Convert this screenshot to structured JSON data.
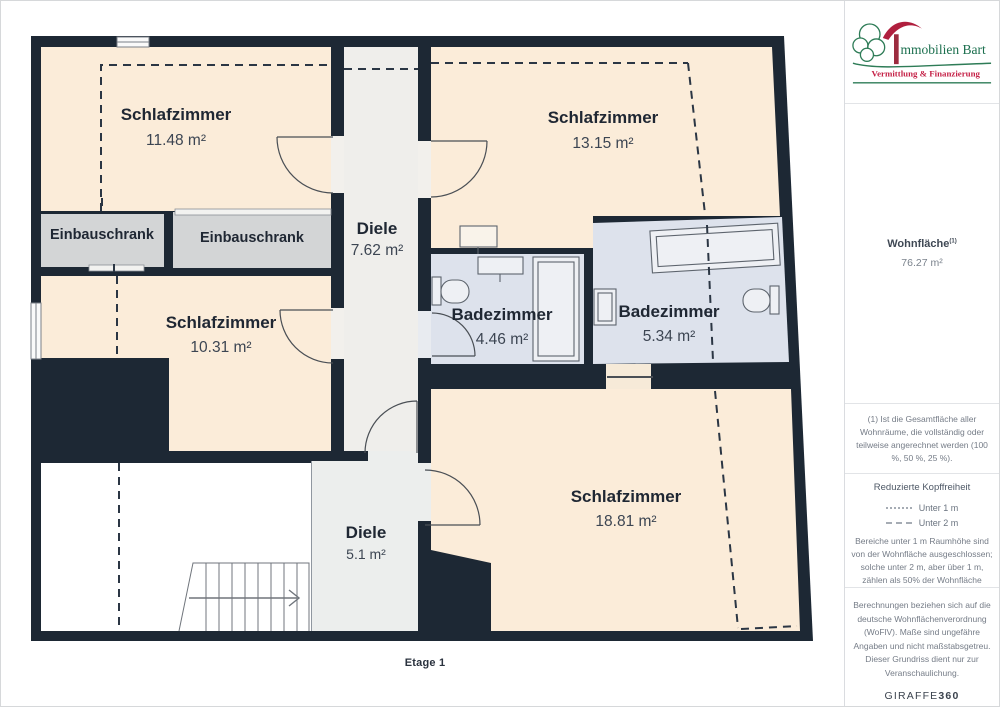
{
  "plan": {
    "floor_label": "Etage 1",
    "rooms": [
      {
        "id": "schlafzimmer-1",
        "name": "Schlafzimmer",
        "area": "11.48 m²"
      },
      {
        "id": "schlafzimmer-2",
        "name": "Schlafzimmer",
        "area": "13.15 m²"
      },
      {
        "id": "einbauschrank-1",
        "name": "Einbauschrank",
        "area": ""
      },
      {
        "id": "einbauschrank-2",
        "name": "Einbauschrank",
        "area": ""
      },
      {
        "id": "diele-1",
        "name": "Diele",
        "area": "7.62 m²"
      },
      {
        "id": "schlafzimmer-3",
        "name": "Schlafzimmer",
        "area": "10.31 m²"
      },
      {
        "id": "badezimmer-1",
        "name": "Badezimmer",
        "area": "4.46 m²"
      },
      {
        "id": "badezimmer-2",
        "name": "Badezimmer",
        "area": "5.34 m²"
      },
      {
        "id": "schlafzimmer-4",
        "name": "Schlafzimmer",
        "area": "18.81 m²"
      },
      {
        "id": "diele-2",
        "name": "Diele",
        "area": "5.1 m²"
      }
    ],
    "colors": {
      "wall": "#1d2834",
      "bedroom": "#fbecd9",
      "bathroom": "#dde2ec",
      "hallway": "#efeeeb",
      "closet": "#d3d5d6",
      "excluded": "#ffffff",
      "dashed_line": "#2b3644"
    }
  },
  "sidebar": {
    "logo": {
      "title": "mmobilien Bart",
      "tagline": "Vermittlung & Finanzierung",
      "green": "#2e7c57",
      "red": "#b01f3e",
      "tagline_red": "#c41f45"
    },
    "living_area": {
      "label": "Wohnfläche",
      "superscript": "(1)",
      "value": "76.27 m²"
    },
    "footnote": "(1) Ist die Gesamtfläche aller Wohnräume, die vollständig oder teilweise angerechnet werden (100 %, 50 %, 25 %).",
    "legend": {
      "title": "Reduzierte Kopffreiheit",
      "items": [
        {
          "style": "dotted",
          "label": "Unter 1 m"
        },
        {
          "style": "dashed",
          "label": "Unter 2 m"
        }
      ],
      "note": "Bereiche unter 1 m Raumhöhe sind von der Wohnfläche ausgeschlossen; solche unter 2 m, aber über 1 m, zählen als 50% der Wohnfläche"
    },
    "disclaimer": "Berechnungen beziehen sich auf die deutsche Wohnflächenverordnung (WoFlV). Maße sind ungefähre Angaben und nicht maßstabsgetreu. Dieser Grundriss dient nur zur Veranschaulichung.",
    "brand": {
      "name": "GIRAFFE",
      "suffix": "360"
    }
  }
}
